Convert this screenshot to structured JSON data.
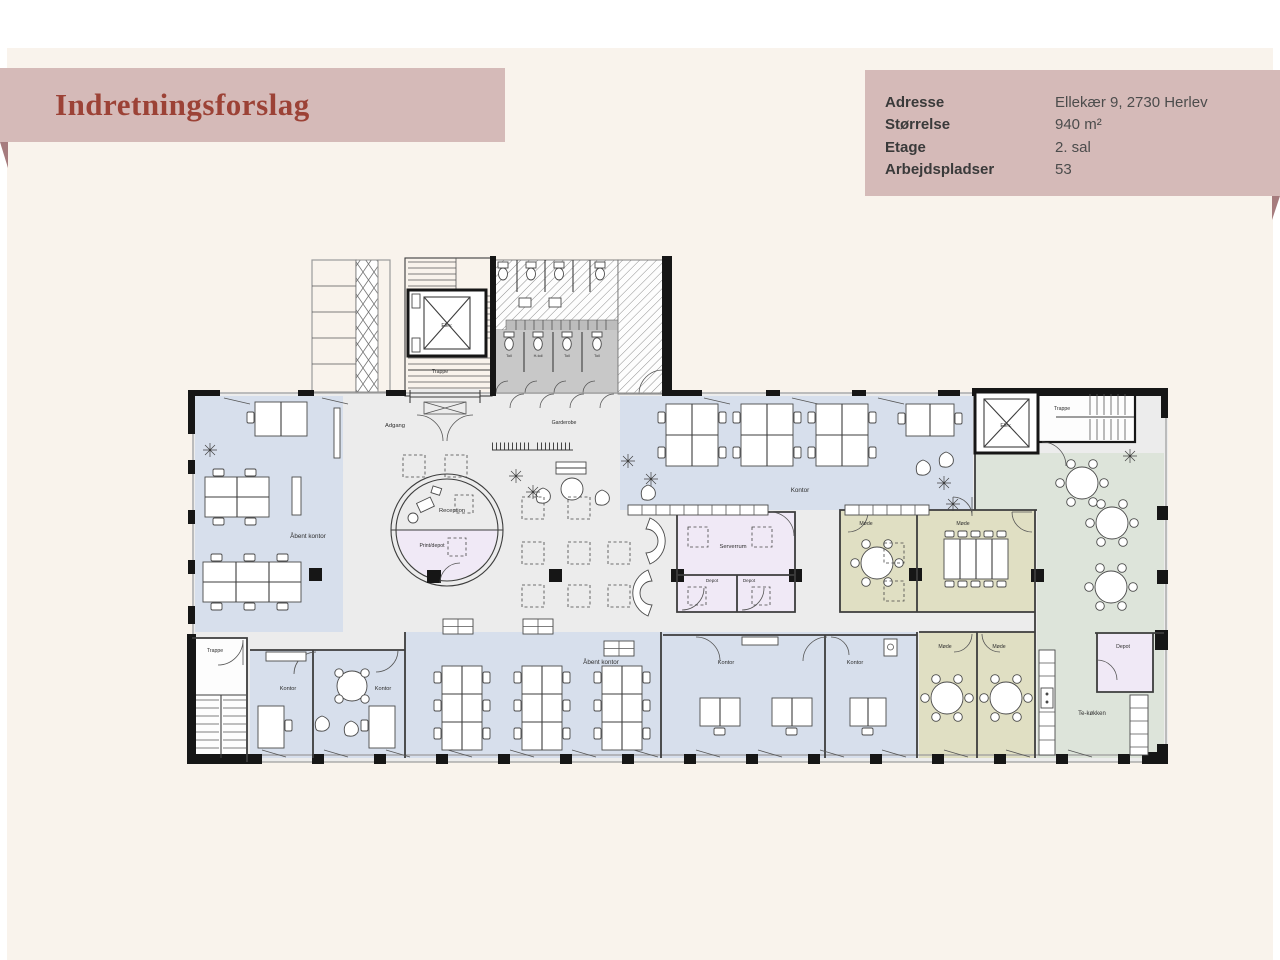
{
  "page": {
    "title": "Indretningsforslag"
  },
  "info_box": {
    "rows": [
      {
        "label": "Adresse",
        "value": "Ellekær 9, 2730 Herlev"
      },
      {
        "label": "Størrelse",
        "value": "940 m²"
      },
      {
        "label": "Etage",
        "value": "2. sal"
      },
      {
        "label": "Arbejdspladser",
        "value": "53"
      }
    ]
  },
  "colors": {
    "page_bg": "#ffffff",
    "card_bg": "#f9f3ec",
    "banner_bg": "#d5bab8",
    "banner_fold": "#a67c7e",
    "title_text": "#9c4236",
    "info_label": "#3a3a3a",
    "info_value": "#4c4c4c",
    "room_blue": "#d7dfec",
    "room_olive": "#e0dfc3",
    "room_green": "#dde4da",
    "room_lavender": "#f0e9f6",
    "floor_grey": "#ececec",
    "toilet_grey": "#c8c8c8",
    "wall": "#161616"
  },
  "floorplan": {
    "labels": [
      {
        "text": "Elev.",
        "x": 447,
        "y": 327,
        "size": 5.2
      },
      {
        "text": "Trappe",
        "x": 440,
        "y": 373,
        "size": 5.2
      },
      {
        "text": "Toil",
        "x": 509,
        "y": 357,
        "size": 3.8
      },
      {
        "text": "H-toil",
        "x": 538,
        "y": 357,
        "size": 3.8
      },
      {
        "text": "Toil",
        "x": 567,
        "y": 357,
        "size": 3.8
      },
      {
        "text": "Toil",
        "x": 597,
        "y": 357,
        "size": 3.8
      },
      {
        "text": "Adgang",
        "x": 395,
        "y": 427,
        "size": 5.8
      },
      {
        "text": "Garderobe",
        "x": 564,
        "y": 424,
        "size": 5.2
      },
      {
        "text": "Åbent kontor",
        "x": 308,
        "y": 538,
        "size": 6.3
      },
      {
        "text": "Reception",
        "x": 452,
        "y": 512,
        "size": 5.8
      },
      {
        "text": "Print/depot",
        "x": 432,
        "y": 547,
        "size": 5.2
      },
      {
        "text": "Kontor",
        "x": 800,
        "y": 492,
        "size": 6.3
      },
      {
        "text": "Serverrum",
        "x": 733,
        "y": 548,
        "size": 5.8
      },
      {
        "text": "Depot",
        "x": 712,
        "y": 582,
        "size": 4.6
      },
      {
        "text": "Depot",
        "x": 749,
        "y": 582,
        "size": 4.6
      },
      {
        "text": "Møde",
        "x": 866,
        "y": 525,
        "size": 5.2
      },
      {
        "text": "Møde",
        "x": 963,
        "y": 525,
        "size": 5.2
      },
      {
        "text": "Elev.",
        "x": 1006,
        "y": 427,
        "size": 5.2
      },
      {
        "text": "Trappe",
        "x": 1062,
        "y": 410,
        "size": 5.2
      },
      {
        "text": "Trappe",
        "x": 215,
        "y": 652,
        "size": 5.2
      },
      {
        "text": "Kontor",
        "x": 288,
        "y": 690,
        "size": 5.6
      },
      {
        "text": "Kontor",
        "x": 383,
        "y": 690,
        "size": 5.6
      },
      {
        "text": "Åbent kontor",
        "x": 601,
        "y": 664,
        "size": 6.3
      },
      {
        "text": "Kontor",
        "x": 726,
        "y": 664,
        "size": 5.6
      },
      {
        "text": "Kontor",
        "x": 855,
        "y": 664,
        "size": 5.6
      },
      {
        "text": "Møde",
        "x": 945,
        "y": 648,
        "size": 5.2
      },
      {
        "text": "Møde",
        "x": 999,
        "y": 648,
        "size": 5.2
      },
      {
        "text": "Depot",
        "x": 1123,
        "y": 648,
        "size": 5.2
      },
      {
        "text": "Te-køkken",
        "x": 1092,
        "y": 715,
        "size": 6.0
      }
    ]
  }
}
